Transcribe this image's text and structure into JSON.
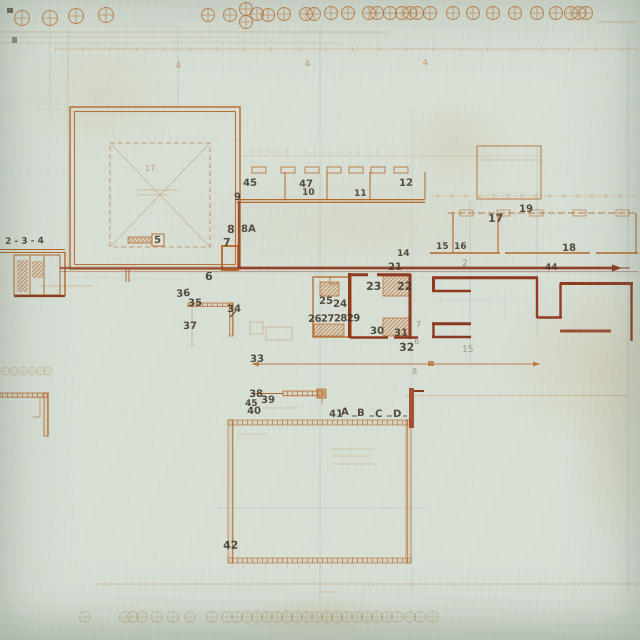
{
  "document": {
    "kind": "scanned architectural floor plan",
    "paper_color": "#d8dfd5",
    "ink_color": "#b5672a",
    "dark_wall_color": "#8e3a20",
    "pencil_color": "#3e362a"
  },
  "labels": [
    {
      "id": "2-3-4",
      "text": "2 - 3 - 4",
      "x": 5,
      "y": 238,
      "s": 9
    },
    {
      "id": "5",
      "text": "5",
      "x": 154,
      "y": 236,
      "s": 10
    },
    {
      "id": "6",
      "text": "6",
      "x": 205,
      "y": 271,
      "s": 11
    },
    {
      "id": "7",
      "text": "7",
      "x": 223,
      "y": 237,
      "s": 11
    },
    {
      "id": "8",
      "text": "8",
      "x": 227,
      "y": 224,
      "s": 11
    },
    {
      "id": "8A",
      "text": "8A",
      "x": 241,
      "y": 225,
      "s": 10
    },
    {
      "id": "9",
      "text": "9",
      "x": 234,
      "y": 193,
      "s": 10
    },
    {
      "id": "45-top",
      "text": "45",
      "x": 243,
      "y": 179,
      "s": 10
    },
    {
      "id": "47",
      "text": "47",
      "x": 299,
      "y": 180,
      "s": 10
    },
    {
      "id": "10",
      "text": "10",
      "x": 302,
      "y": 189,
      "s": 9
    },
    {
      "id": "11",
      "text": "11",
      "x": 354,
      "y": 190,
      "s": 9
    },
    {
      "id": "12",
      "text": "12",
      "x": 399,
      "y": 179,
      "s": 10
    },
    {
      "id": "14",
      "text": "14",
      "x": 397,
      "y": 250,
      "s": 9
    },
    {
      "id": "17",
      "text": "17",
      "x": 488,
      "y": 213,
      "s": 11
    },
    {
      "id": "19",
      "text": "19",
      "x": 519,
      "y": 205,
      "s": 10
    },
    {
      "id": "15",
      "text": "15",
      "x": 436,
      "y": 243,
      "s": 9
    },
    {
      "id": "16",
      "text": "16",
      "x": 454,
      "y": 243,
      "s": 9
    },
    {
      "id": "18",
      "text": "18",
      "x": 562,
      "y": 244,
      "s": 10
    },
    {
      "id": "44",
      "text": "44",
      "x": 545,
      "y": 264,
      "s": 9
    },
    {
      "id": "21",
      "text": "21",
      "x": 388,
      "y": 263,
      "s": 10
    },
    {
      "id": "23",
      "text": "23",
      "x": 366,
      "y": 281,
      "s": 11
    },
    {
      "id": "22",
      "text": "22",
      "x": 397,
      "y": 281,
      "s": 11
    },
    {
      "id": "25",
      "text": "25",
      "x": 319,
      "y": 297,
      "s": 10
    },
    {
      "id": "24",
      "text": "24",
      "x": 333,
      "y": 300,
      "s": 10
    },
    {
      "id": "26272829",
      "text": "26272829",
      "x": 308,
      "y": 315,
      "s": 10,
      "ls": -0.5
    },
    {
      "id": "30",
      "text": "30",
      "x": 370,
      "y": 327,
      "s": 10
    },
    {
      "id": "31",
      "text": "31",
      "x": 394,
      "y": 329,
      "s": 10
    },
    {
      "id": "32",
      "text": "32",
      "x": 399,
      "y": 342,
      "s": 11
    },
    {
      "id": "36",
      "text": "36",
      "x": 176,
      "y": 290,
      "s": 10,
      "rot": -5
    },
    {
      "id": "35",
      "text": "35",
      "x": 188,
      "y": 299,
      "s": 10
    },
    {
      "id": "37",
      "text": "37",
      "x": 183,
      "y": 322,
      "s": 10
    },
    {
      "id": "34",
      "text": "34",
      "x": 227,
      "y": 305,
      "s": 10
    },
    {
      "id": "33",
      "text": "33",
      "x": 250,
      "y": 355,
      "s": 10
    },
    {
      "id": "38",
      "text": "38",
      "x": 249,
      "y": 390,
      "s": 10
    },
    {
      "id": "39",
      "text": "39",
      "x": 261,
      "y": 396,
      "s": 10
    },
    {
      "id": "45-small",
      "text": "45",
      "x": 245,
      "y": 400,
      "s": 9
    },
    {
      "id": "40",
      "text": "40",
      "x": 247,
      "y": 407,
      "s": 10
    },
    {
      "id": "41",
      "text": "41",
      "x": 329,
      "y": 410,
      "s": 10
    },
    {
      "id": "A",
      "text": "A",
      "x": 341,
      "y": 408,
      "s": 10
    },
    {
      "id": "B",
      "text": "B",
      "x": 357,
      "y": 409,
      "s": 10
    },
    {
      "id": "C",
      "text": "C",
      "x": 375,
      "y": 410,
      "s": 10
    },
    {
      "id": "D",
      "text": "D",
      "x": 393,
      "y": 410,
      "s": 10
    },
    {
      "id": "42",
      "text": "42",
      "x": 223,
      "y": 540,
      "s": 11
    },
    {
      "id": "2-faint",
      "text": "2",
      "x": 462,
      "y": 260,
      "s": 9,
      "cls": "soft"
    },
    {
      "id": "7-faint",
      "text": "7",
      "x": 416,
      "y": 321,
      "s": 8,
      "cls": "soft"
    },
    {
      "id": "6-faint",
      "text": "6",
      "x": 414,
      "y": 338,
      "s": 8,
      "cls": "soft"
    },
    {
      "id": "8-faint",
      "text": "8",
      "x": 412,
      "y": 368,
      "s": 8,
      "cls": "soft"
    },
    {
      "id": "15-faint",
      "text": "15",
      "x": 462,
      "y": 346,
      "s": 9,
      "cls": "soft"
    },
    {
      "id": "17-room",
      "text": "17.",
      "x": 145,
      "y": 165,
      "s": 8,
      "cls": "orange"
    },
    {
      "id": "sec4-1",
      "text": "4",
      "x": 175,
      "y": 63,
      "s": 9,
      "cls": "orange",
      "rot": -8
    },
    {
      "id": "sec4-2",
      "text": "4",
      "x": 304,
      "y": 61,
      "s": 9,
      "cls": "orange",
      "rot": -8
    },
    {
      "id": "sec4-3",
      "text": "4",
      "x": 422,
      "y": 60,
      "s": 9,
      "cls": "orange",
      "rot": -8
    }
  ],
  "grid_markers": {
    "top": [
      [
        22,
        18
      ],
      [
        50,
        18
      ],
      [
        76,
        16
      ],
      [
        106,
        15
      ],
      [
        208,
        15
      ],
      [
        230,
        15
      ],
      [
        246,
        9
      ],
      [
        246,
        22
      ],
      [
        257,
        14
      ],
      [
        268,
        15
      ],
      [
        284,
        14
      ],
      [
        306,
        14
      ],
      [
        314,
        14
      ],
      [
        331,
        13
      ],
      [
        348,
        13
      ],
      [
        369,
        13
      ],
      [
        377,
        13
      ],
      [
        390,
        13
      ],
      [
        402,
        13
      ],
      [
        410,
        13
      ],
      [
        417,
        13
      ],
      [
        430,
        13
      ],
      [
        453,
        13
      ],
      [
        473,
        13
      ],
      [
        493,
        13
      ],
      [
        515,
        13
      ],
      [
        537,
        13
      ],
      [
        556,
        13
      ],
      [
        571,
        13
      ],
      [
        579,
        13
      ],
      [
        586,
        13
      ]
    ],
    "bottom_y": 617,
    "bottom_x": [
      85,
      125,
      133,
      142,
      157,
      173,
      190,
      212,
      227,
      237,
      247,
      257,
      267,
      277,
      287,
      297,
      307,
      317,
      327,
      337,
      347,
      357,
      367,
      377,
      387,
      397,
      410,
      420,
      433
    ],
    "left_y": 371,
    "left_x": [
      5,
      14,
      23,
      32,
      41,
      48
    ]
  }
}
